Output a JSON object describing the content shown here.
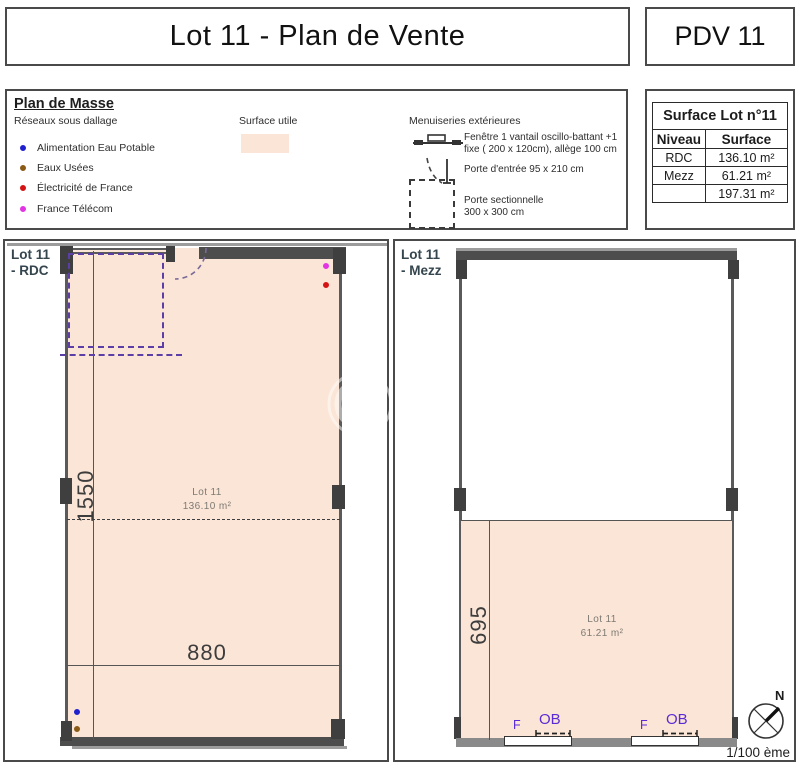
{
  "header": {
    "title": "Lot 11 - Plan de Vente",
    "code": "PDV 11"
  },
  "legend": {
    "title": "Plan de Masse",
    "networks_title": "Réseaux sous dallage",
    "items": [
      {
        "label": "Alimentation Eau Potable",
        "color": "#2020cf"
      },
      {
        "label": "Eaux Usées",
        "color": "#8a5a16"
      },
      {
        "label": "Électricité de France",
        "color": "#d41414"
      },
      {
        "label": "France Télécom",
        "color": "#e234e2"
      }
    ],
    "surface_utile": {
      "label": "Surface utile",
      "color": "#fbe5d6"
    },
    "menuiseries": {
      "title": "Menuiseries extérieures",
      "fenetre_line1": "Fenêtre 1 vantail oscillo-battant +1",
      "fenetre_line2": "fixe ( 200 x 120cm), allège 100 cm",
      "porte_entree": "Porte d'entrée 95 x 210 cm",
      "porte_sectionnelle_line1": "Porte sectionnelle",
      "porte_sectionnelle_line2": "300 x 300 cm"
    }
  },
  "surface_table": {
    "title": "Surface Lot n°11",
    "columns": [
      "Niveau",
      "Surface"
    ],
    "rows": [
      {
        "niveau": "RDC",
        "surface": "136.10 m²"
      },
      {
        "niveau": "Mezz",
        "surface": "61.21 m²"
      },
      {
        "niveau": "",
        "surface": "197.31 m²"
      }
    ]
  },
  "plans": {
    "rdc": {
      "label_line1": "Lot 11",
      "label_line2": "- RDC",
      "room_name": "Lot 11",
      "room_area": "136.10 m²",
      "dim_vertical": "1550",
      "dim_horizontal": "880"
    },
    "mezz": {
      "label_line1": "Lot 11",
      "label_line2": "- Mezz",
      "room_name": "Lot 11",
      "room_area": "61.21 m²",
      "dim_vertical": "695",
      "window_fixed_label": "F",
      "window_ob_label": "OB"
    }
  },
  "footer": {
    "north_label": "N",
    "scale_label": "1/100 ème"
  },
  "colors": {
    "surface_fill": "#fbe5d6",
    "wall_dark": "#4d4d4d",
    "wall_line": "#5a5a5a",
    "dashed_zone": "#5c3fa6",
    "window_text": "#5a2bd6"
  }
}
